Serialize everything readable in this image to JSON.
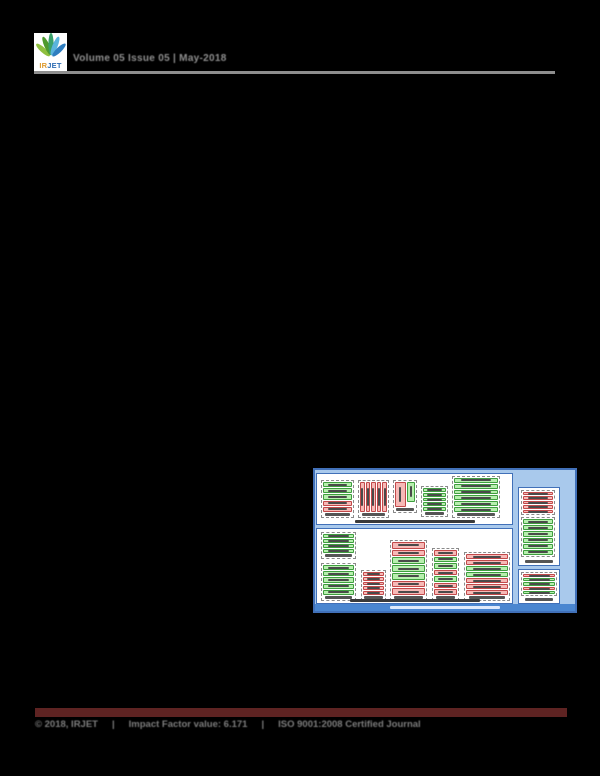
{
  "header": {
    "logo": {
      "ir": "IR",
      "jet": "JET"
    },
    "issue_line": "Volume 05 Issue 05 | May-2018"
  },
  "figure": {
    "text_legible": false,
    "colors": {
      "background": "#a9c9ec",
      "panel_border": "#4170b8",
      "green_fill": "#b7efae",
      "green_border": "#3f9e3f",
      "pink_fill": "#f6b9b6",
      "pink_border": "#c2494a",
      "title_bar": "#4a86d0"
    },
    "top_panel": {
      "groups": [
        {
          "boxes": [
            "green",
            "green",
            "green",
            "pink",
            "pink"
          ]
        },
        {
          "boxes": [
            "pink",
            "pink",
            "pink",
            "pink",
            "pink"
          ]
        },
        {
          "boxes": [
            "pink",
            "green"
          ]
        },
        {
          "boxes": [
            "green",
            "green",
            "green",
            "green",
            "green"
          ]
        },
        {
          "boxes": [
            "green",
            "green",
            "green",
            "green",
            "green",
            "green"
          ]
        }
      ]
    },
    "bottom_panel": {
      "groups": [
        {
          "boxes": [
            "green",
            "green",
            "green",
            "green"
          ]
        },
        {
          "boxes": [
            "green",
            "green",
            "green",
            "green",
            "green"
          ]
        },
        {
          "boxes": [
            "pink",
            "pink",
            "pink",
            "pink",
            "pink"
          ]
        },
        {
          "boxes": [
            "pink",
            "pink",
            "green",
            "green",
            "green",
            "pink",
            "pink"
          ]
        },
        {
          "boxes": [
            "pink",
            "green",
            "green",
            "pink",
            "green",
            "pink",
            "pink"
          ]
        },
        {
          "boxes": [
            "pink",
            "pink",
            "green",
            "green",
            "pink",
            "pink",
            "pink"
          ]
        }
      ]
    },
    "right_top_panel": {
      "groups": [
        {
          "boxes": [
            "pink",
            "pink",
            "pink",
            "pink",
            "pink"
          ]
        },
        {
          "boxes": [
            "green",
            "green",
            "green",
            "green",
            "green",
            "green"
          ]
        }
      ]
    },
    "right_bottom_panel": {
      "groups": [
        {
          "boxes": [
            "pink",
            "green",
            "green",
            "pink",
            "green"
          ]
        }
      ]
    }
  },
  "footer": {
    "bar_color": "#5e2322",
    "copyright": "© 2018, IRJET",
    "separator1": "|",
    "impact_factor": "Impact Factor value: 6.171",
    "separator2": "|",
    "certification": "ISO 9001:2008 Certified Journal"
  }
}
